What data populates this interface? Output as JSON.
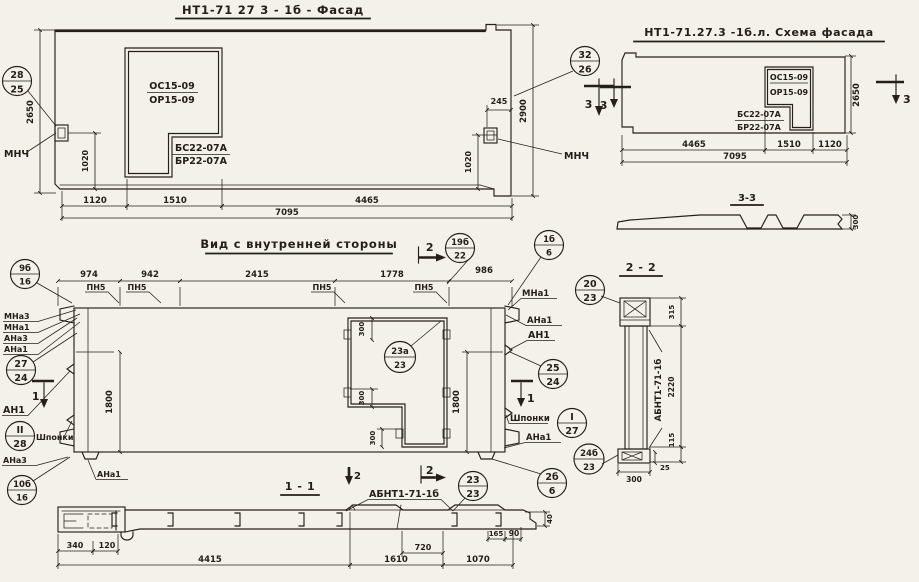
{
  "sheet": {
    "paper": "#f3f1ea",
    "ink": "#242019"
  },
  "facade": {
    "title": "НТ1-71 27 3 - 1б - Фасад",
    "window": {
      "os": "ОС15-09",
      "or": "ОР15-09",
      "bs": "БС22-07А",
      "br": "БР22-07А"
    },
    "mnch": "МНЧ",
    "section_mark": "3",
    "callout_28_25": {
      "top": "28",
      "bot": "25"
    },
    "callout_32_26": {
      "top": "32",
      "bot": "26"
    },
    "dims": {
      "d1120": "1120",
      "d1510": "1510",
      "d4465": "4465",
      "d7095": "7095",
      "d2650": "2650",
      "d2900": "2900",
      "d1020": "1020",
      "d245": "245"
    }
  },
  "schema": {
    "title": "НТ1-71.27.3 -1б.л. Схема фасада",
    "window": {
      "os": "ОС15-09",
      "or": "ОР15-09",
      "bs": "БС22-07А",
      "br": "БР22-07А"
    },
    "section_mark": "3",
    "section_title": "3-3",
    "dims": {
      "d4465": "4465",
      "d1510": "1510",
      "d1120": "1120",
      "d7095": "7095",
      "d2650": "2650",
      "d300": "300"
    }
  },
  "inner": {
    "title": "Вид с внутренней стороны",
    "pn5": "ПН5",
    "shponki": "Шпонки",
    "labels": {
      "mna3": "МНа3",
      "mna1": "МНа1",
      "ana3": "АНа3",
      "ana1": "АНа1",
      "an1": "АН1"
    },
    "marks": {
      "s1": "1",
      "s2": "2"
    },
    "callouts": {
      "c9b16": {
        "top": "9б",
        "bot": "16"
      },
      "c19b22": {
        "top": "19б",
        "bot": "22"
      },
      "c1b6": {
        "top": "1б",
        "bot": "6"
      },
      "c27_24": {
        "top": "27",
        "bot": "24"
      },
      "cII_28": {
        "top": "II",
        "bot": "28"
      },
      "c10b16": {
        "top": "10б",
        "bot": "16"
      },
      "c23a_23": {
        "top": "23а",
        "bot": "23"
      },
      "c25_24": {
        "top": "25",
        "bot": "24"
      },
      "cI_27": {
        "top": "I",
        "bot": "27"
      },
      "c2b_6": {
        "top": "2б",
        "bot": "6"
      },
      "c23_23": {
        "top": "23",
        "bot": "23"
      }
    },
    "dims": {
      "d974": "974",
      "d942": "942",
      "d2415": "2415",
      "d1778": "1778",
      "d986": "986",
      "d1800": "1800",
      "d300": "300"
    }
  },
  "s22": {
    "title": "2 - 2",
    "part": "АБНТ1-71-1б",
    "callouts": {
      "c20_23": {
        "top": "20",
        "bot": "23"
      },
      "c24b_23": {
        "top": "24б",
        "bot": "23"
      }
    },
    "dims": {
      "d315": "315",
      "d2220": "2220",
      "d115": "115",
      "d25": "25",
      "d300": "300"
    }
  },
  "s11": {
    "title": "1 - 1",
    "part": "АБНТ1-71-1б",
    "dims": {
      "d340": "340",
      "d120": "120",
      "d4415": "4415",
      "d1610": "1610",
      "d1070": "1070",
      "d720": "720",
      "d165": "165",
      "d90": "90",
      "d40": "40"
    }
  }
}
